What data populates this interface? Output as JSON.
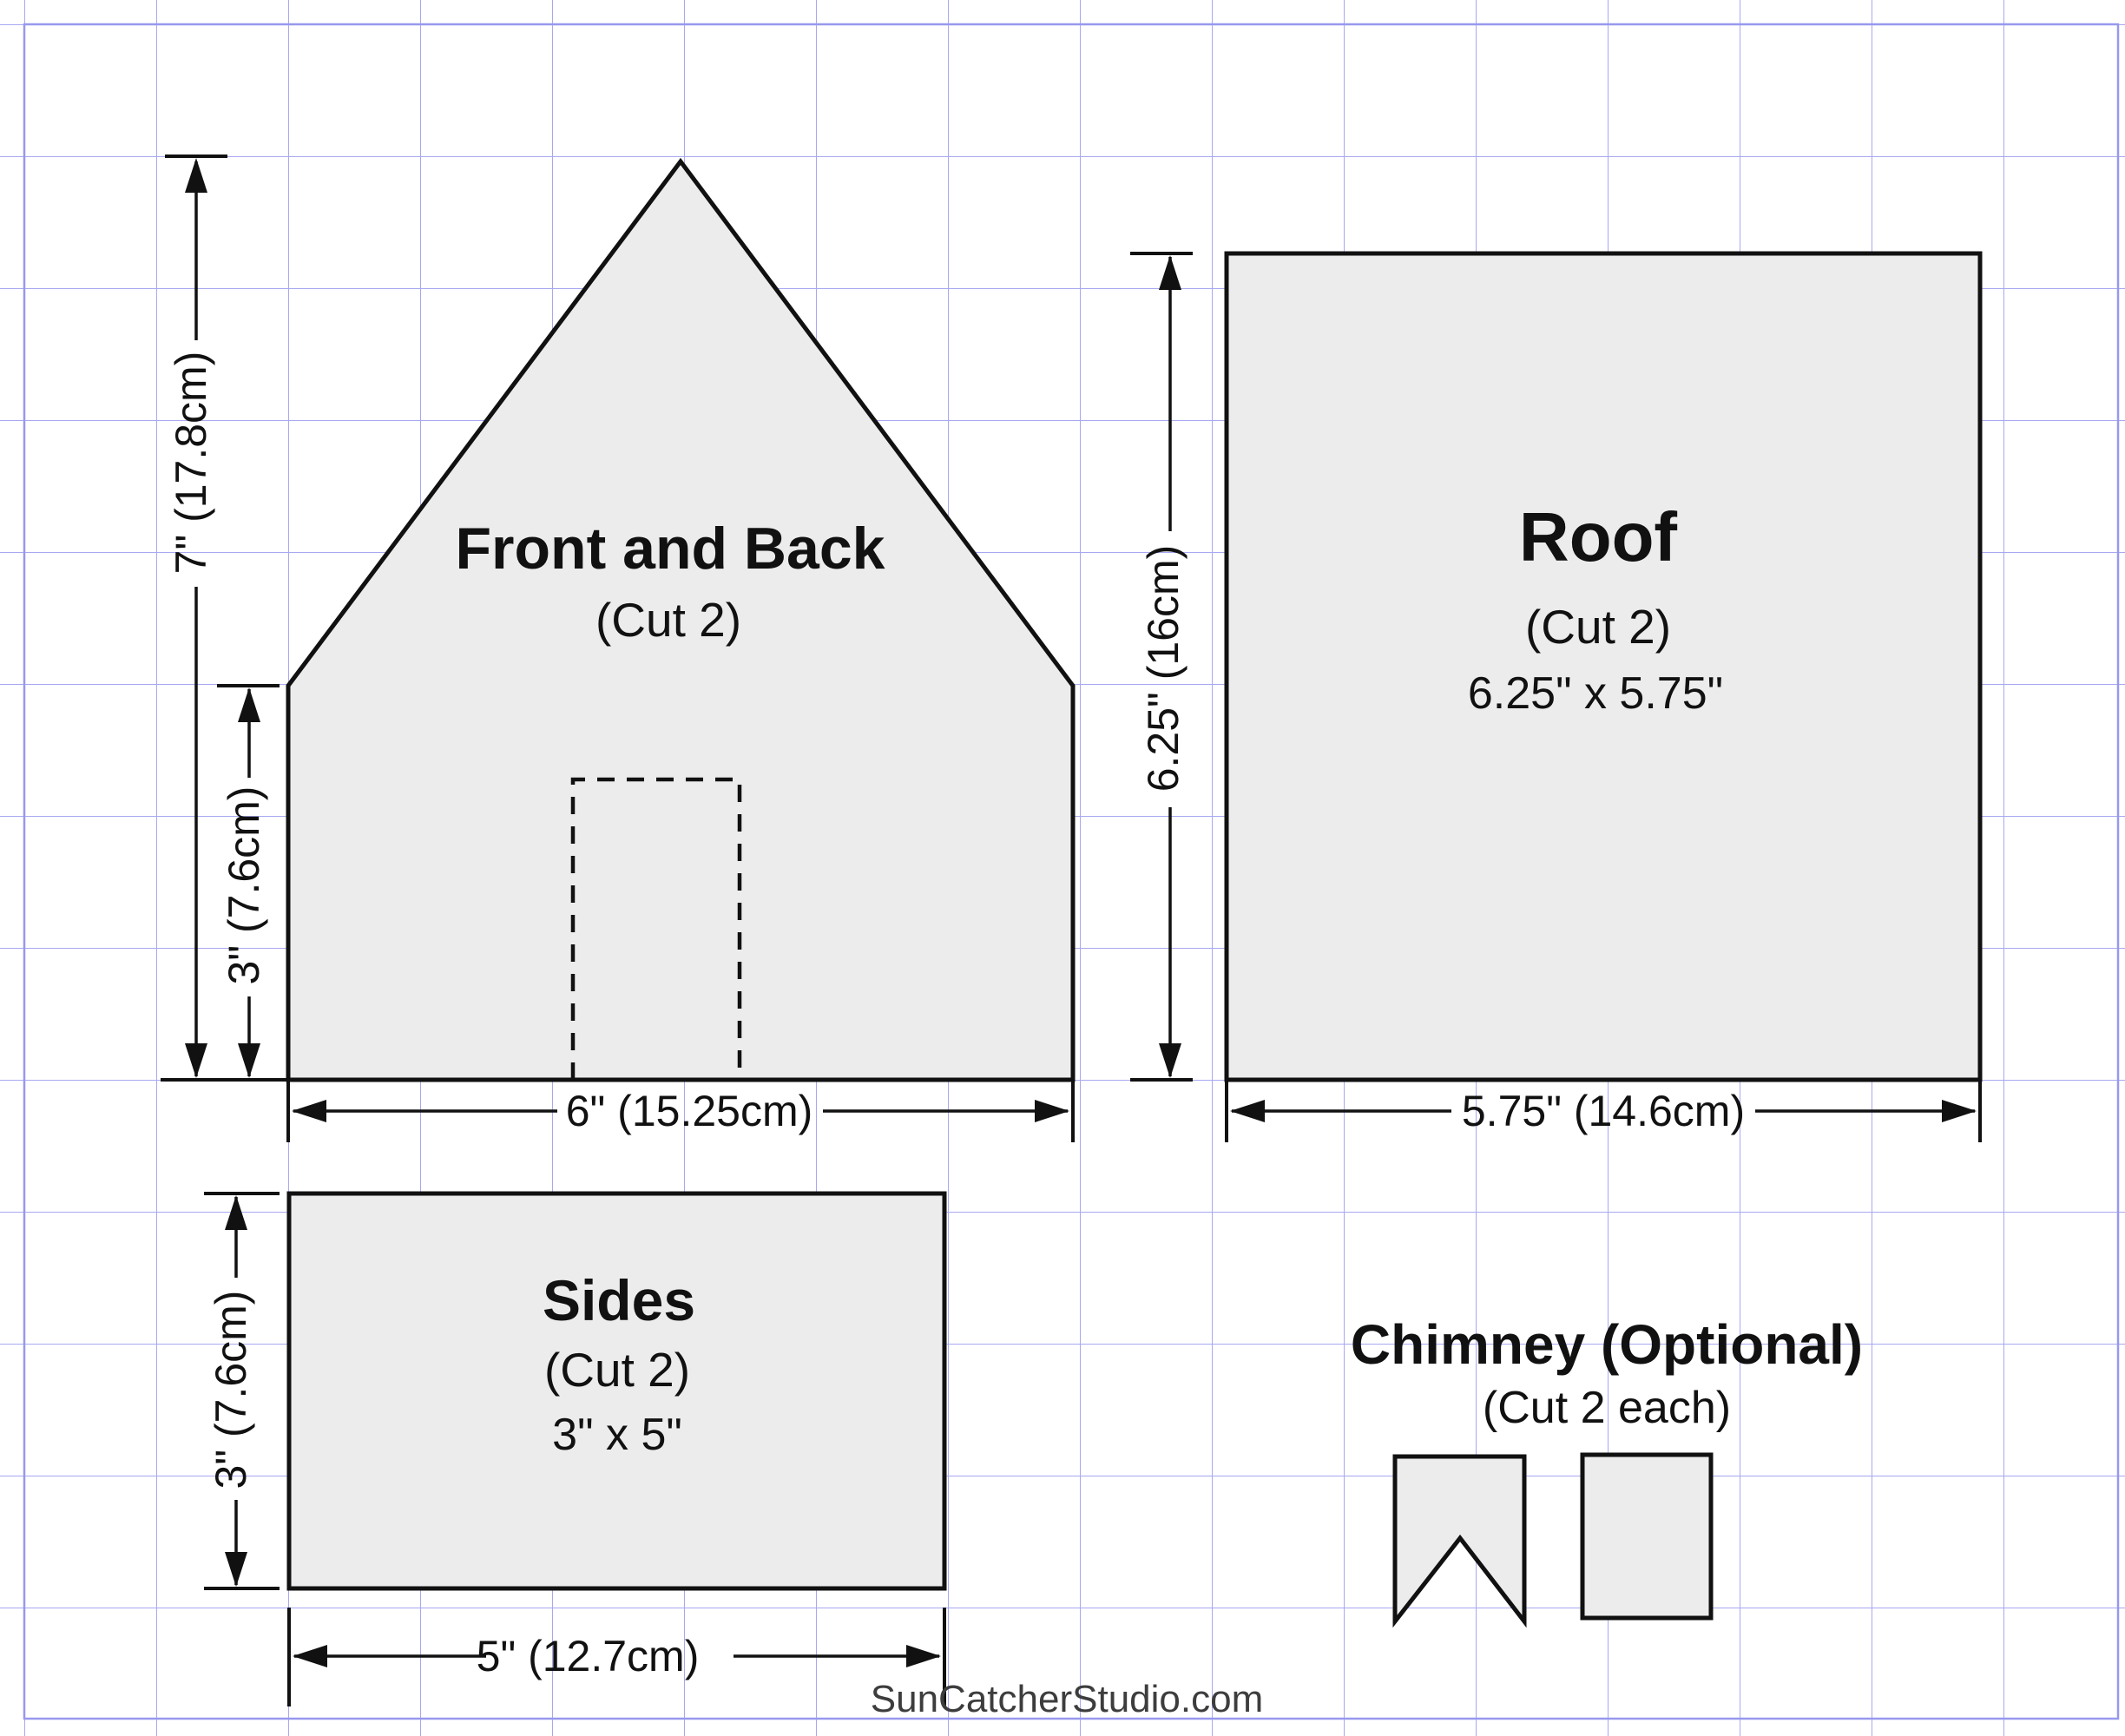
{
  "watermark": "SunCatcherStudio.com",
  "colors": {
    "grid": "#a8a8f2",
    "grid_border": "#9898ee",
    "ink": "#111111",
    "piece_fill": "#ececec",
    "watermark_color": "#3d3d3d",
    "background": "#ffffff"
  },
  "pieces": {
    "front_back": {
      "title": "Front and Back",
      "cut": "(Cut 2)"
    },
    "roof": {
      "title": "Roof",
      "cut": "(Cut 2)",
      "size": "6.25\" x 5.75\""
    },
    "sides": {
      "title": "Sides",
      "cut": "(Cut 2)",
      "size": "3\" x 5\""
    },
    "chimney": {
      "title": "Chimney (Optional)",
      "cut": "(Cut 2 each)"
    }
  },
  "dimensions": {
    "front_total_height": "7\" (17.8cm)",
    "front_wall_height": "3\" (7.6cm)",
    "front_width": "6\" (15.25cm)",
    "roof_height": "6.25\" (16cm)",
    "roof_width": "5.75\" (14.6cm)",
    "side_height": "3\" (7.6cm)",
    "side_width": "5\" (12.7cm)"
  }
}
